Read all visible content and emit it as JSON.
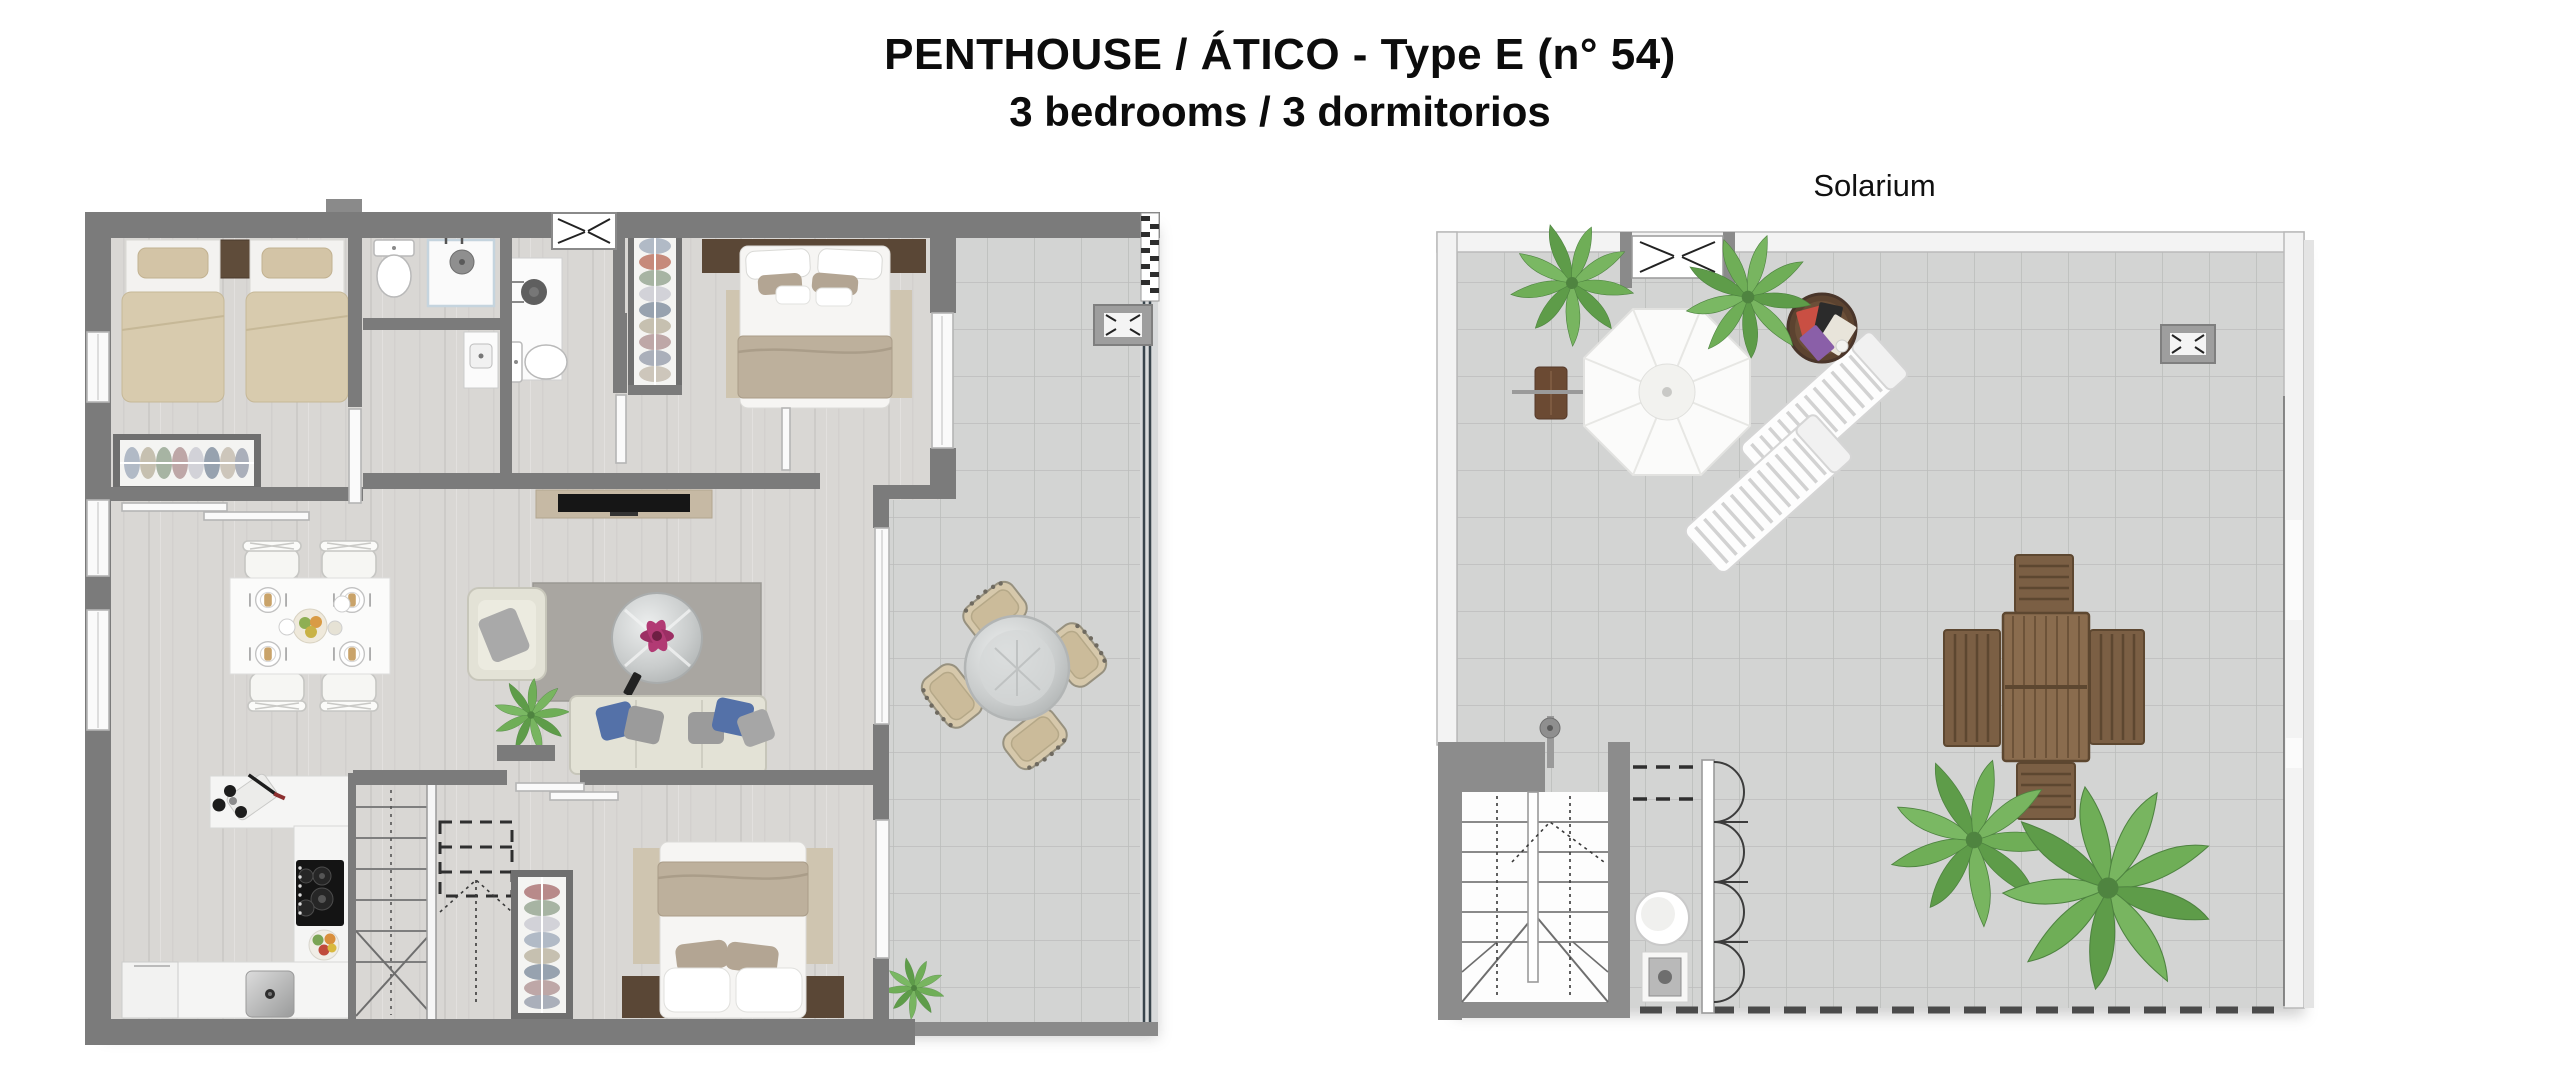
{
  "title": {
    "line1": "PENTHOUSE / ÁTICO - Type E (n° 54)",
    "line2": "3 bedrooms / 3 dormitorios"
  },
  "solarium": {
    "label": "Solarium"
  },
  "colors": {
    "wall_gray": "#7b7b7b",
    "solarium_wall": "#f3f3f3",
    "wood_floor": "#d9d7d4",
    "tile_floor": "#d3d4d3",
    "tile_line": "#bcbdbc",
    "bed_linen_beige": "#d8cbae",
    "blanket_taupe": "#bdb09c",
    "headboard_brown": "#5a4736",
    "outdoor_wood": "#7b5f44",
    "palm_green": "#6fae57",
    "pillow_blue": "#5471a8",
    "rug_gray": "#a9a6a1",
    "rug_tan": "#cfc5b0"
  },
  "plans": {
    "main": {
      "name": "main-floor-plan",
      "rooms": [
        "twin-bedroom",
        "bathroom-a",
        "bathroom-b",
        "bathroom-c",
        "master-bedroom",
        "hallway",
        "living-room",
        "dining-area",
        "kitchen",
        "bedroom-3",
        "staircase",
        "terrace"
      ],
      "furniture": [
        "twin-bed",
        "twin-bed",
        "nightstand",
        "wardrobe",
        "toilet",
        "shower",
        "vanity",
        "double-bed",
        "tv-unit",
        "sofa",
        "armchair",
        "coffee-table",
        "plant",
        "dining-table",
        "dining-chairs",
        "kitchen-counter",
        "cooktop",
        "sink",
        "fridge",
        "round-terrace-table",
        "wicker-chairs",
        "air-conditioning-unit",
        "skylight-window"
      ]
    },
    "solarium": {
      "name": "solarium-plan",
      "features": [
        "parasol",
        "sun-lounger",
        "sun-lounger",
        "side-table",
        "magazine-table",
        "palm-plant",
        "outdoor-dining-table",
        "outdoor-chairs",
        "staircase",
        "outdoor-shower",
        "utility-closet",
        "folding-doors",
        "air-conditioning-unit",
        "stair-skylight"
      ]
    }
  }
}
